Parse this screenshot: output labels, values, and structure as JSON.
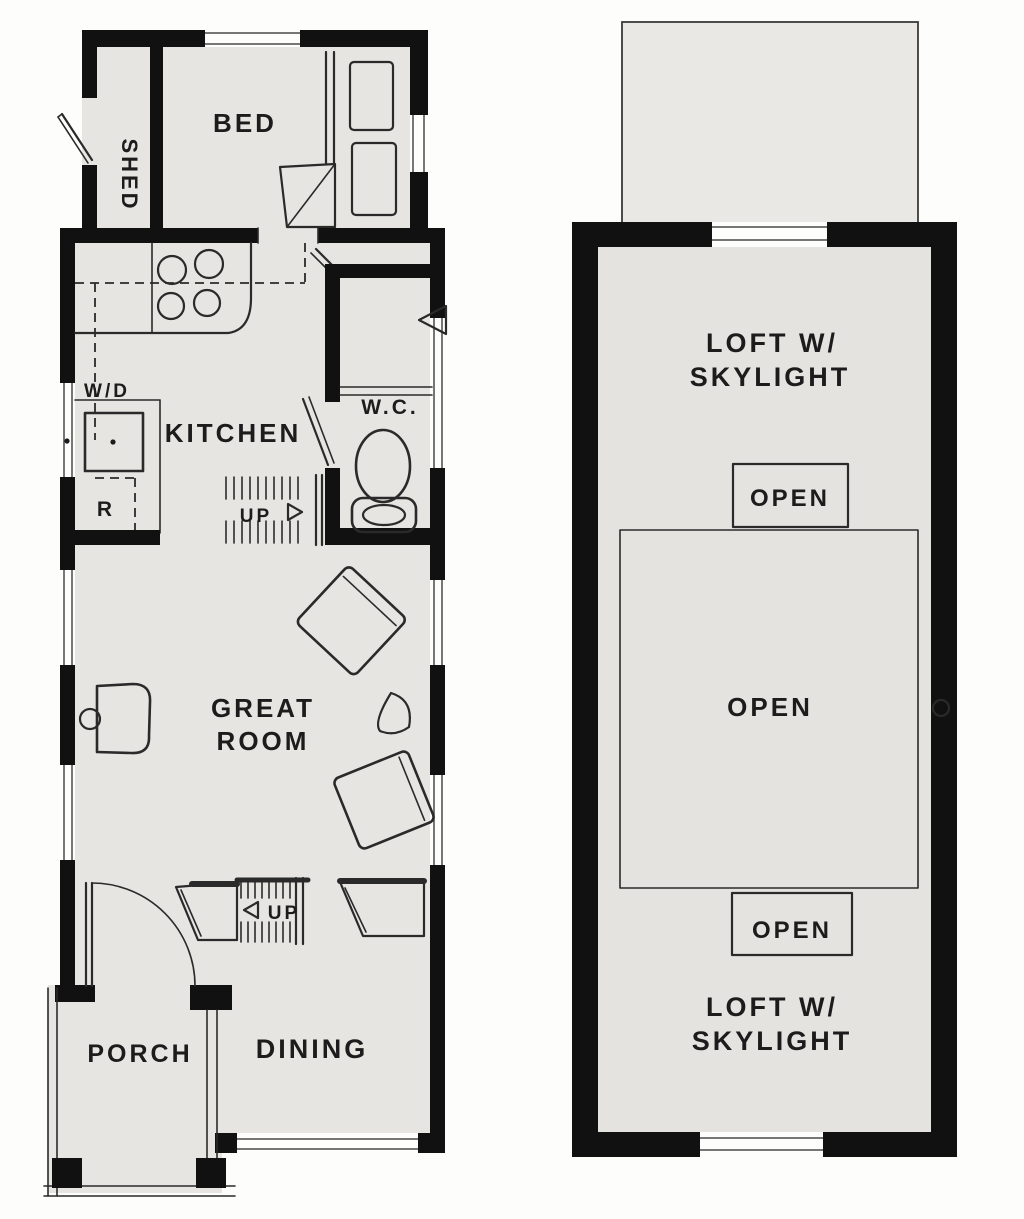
{
  "document_type": "tiny-house-floor-plan-sketch",
  "first_floor": {
    "shed_label": "SHED",
    "bed_label": "BED",
    "kitchen_label": "KITCHEN",
    "washer_dryer_label": "W/D",
    "refrigerator_label": "R",
    "wc_label": "W.C.",
    "kitchen_stair_label": "UP",
    "entry_stair_label": "UP",
    "great_room_label_line1": "GREAT",
    "great_room_label_line2": "ROOM",
    "porch_label": "PORCH",
    "dining_label": "DINING"
  },
  "loft": {
    "label_top_line1": "LOFT W/",
    "label_top_line2": "SKYLIGHT",
    "open_top_label": "OPEN",
    "open_center_label": "OPEN",
    "open_bottom_label": "OPEN",
    "label_bottom_line1": "LOFT W/",
    "label_bottom_line2": "SKYLIGHT"
  },
  "colors": {
    "wall": "#111111",
    "floor": "#e7e5e2",
    "loft_floor": "#e5e3e0",
    "roof_outline_fill": "#eae8e5",
    "line": "#2a2a2a",
    "text": "#1c1c1c",
    "background": "#fdfdfc"
  }
}
